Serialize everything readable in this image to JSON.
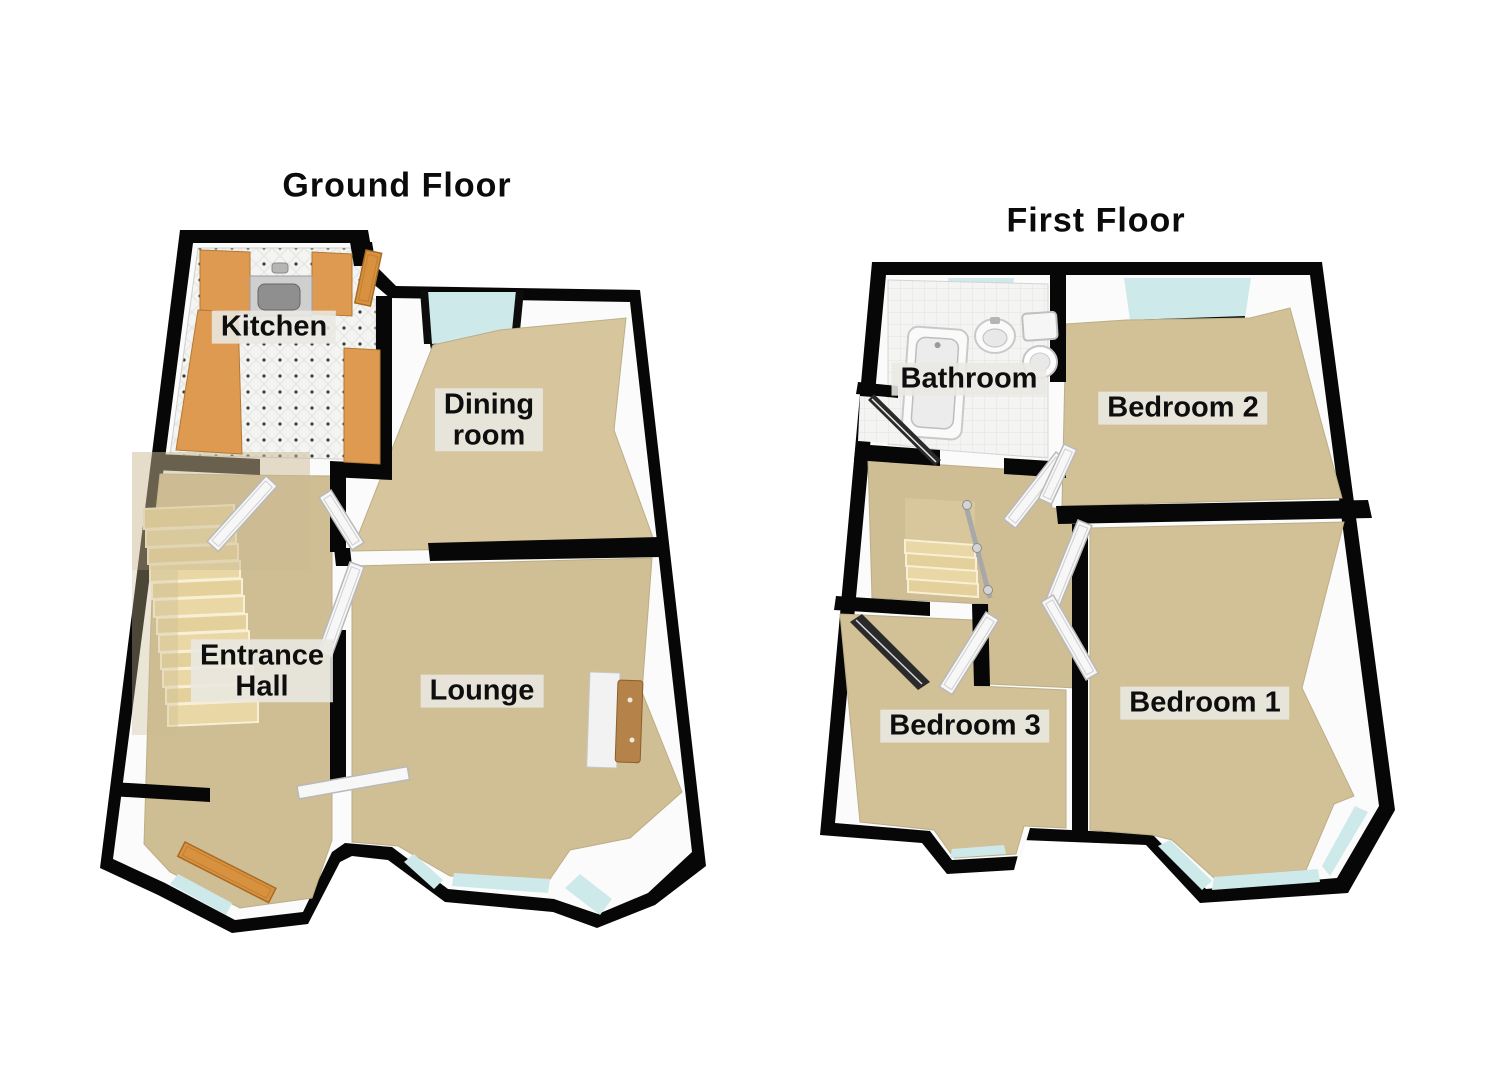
{
  "page": {
    "background": "#ffffff"
  },
  "colors": {
    "wall": "#070707",
    "wall_inner_face": "#fbfbfb",
    "floor_tan": "#d3c198",
    "tile_white": "#f4f4f2",
    "window_glass": "#cde9e9",
    "kitchen_counter_orange": "#df9a52",
    "stairs_cream": "#e9d7a5",
    "door_white": "#f6f6f6",
    "door_orange": "#d8923f",
    "label_background": "#e9e8e3",
    "label_text": "#0e0e0e"
  },
  "plans": [
    {
      "title": "Ground Floor",
      "rooms": [
        {
          "name": "kitchen",
          "label": "Kitchen"
        },
        {
          "name": "dining-room",
          "label": "Dining\nroom"
        },
        {
          "name": "entrance-hall",
          "label": "Entrance\nHall"
        },
        {
          "name": "lounge",
          "label": "Lounge"
        }
      ],
      "icons": [
        "stairs-icon",
        "kitchen-sink-icon",
        "kitchen-counter-icon",
        "interior-door-icon",
        "front-door-icon",
        "back-door-icon",
        "bay-window-icon",
        "window-icon",
        "sideboard-icon"
      ]
    },
    {
      "title": "First Floor",
      "rooms": [
        {
          "name": "bathroom",
          "label": "Bathroom"
        },
        {
          "name": "bedroom-2",
          "label": "Bedroom 2"
        },
        {
          "name": "bedroom-3",
          "label": "Bedroom 3"
        },
        {
          "name": "bedroom-1",
          "label": "Bedroom 1"
        }
      ],
      "icons": [
        "bathtub-icon",
        "wash-basin-icon",
        "toilet-icon",
        "stairs-icon",
        "banister-icon",
        "interior-door-icon",
        "wardrobe-icon",
        "bay-window-icon",
        "window-icon"
      ]
    }
  ]
}
